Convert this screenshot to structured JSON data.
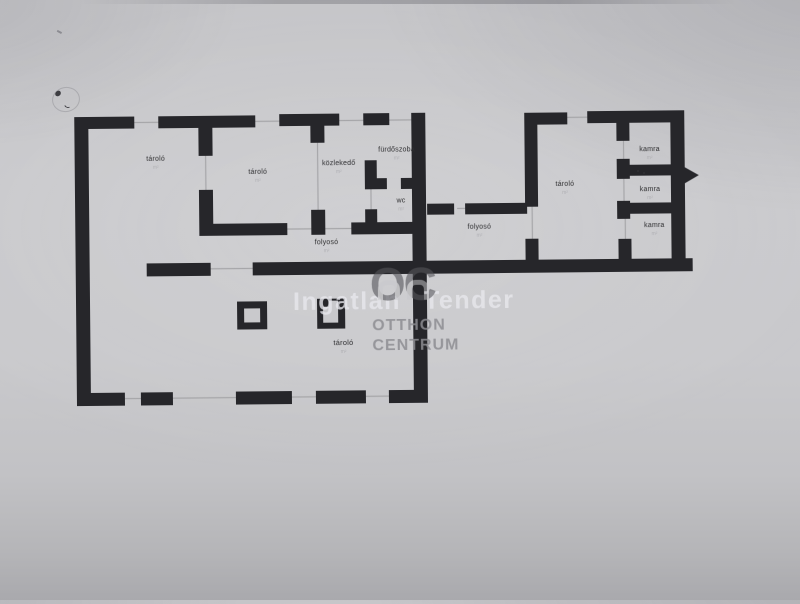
{
  "document": {
    "kind": "floor plan sketch (scanned photo)",
    "language": "Hungarian"
  },
  "colors": {
    "paper": "#c9c9cc",
    "wall": "#26262a",
    "room_label": "#2e2e30",
    "area_text": "#b0b0b4",
    "watermark_light": "#e7e7ec",
    "watermark_gray": "#8d8d92"
  },
  "rooms": [
    {
      "name": "tarolo-top-left",
      "label": "tároló",
      "area": "m²"
    },
    {
      "name": "tarolo-top-mid",
      "label": "tároló",
      "area": "m²"
    },
    {
      "name": "kozlekedo",
      "label": "közlekedő",
      "area": "m²"
    },
    {
      "name": "furdoszoba",
      "label": "fürdőszoba",
      "area": "m²"
    },
    {
      "name": "wc",
      "label": "wc",
      "area": "m²"
    },
    {
      "name": "folyoso-left",
      "label": "folyosó",
      "area": "m²"
    },
    {
      "name": "folyoso-right",
      "label": "folyosó",
      "area": "m²"
    },
    {
      "name": "tarolo-right",
      "label": "tároló",
      "area": "m²"
    },
    {
      "name": "kamra-top",
      "label": "kamra",
      "area": "m²"
    },
    {
      "name": "kamra-middle",
      "label": "kamra",
      "area": "m²"
    },
    {
      "name": "kamra-bottom",
      "label": "kamra",
      "area": "m²"
    },
    {
      "name": "tarolo-bottom",
      "label": "tároló",
      "area": "m²"
    }
  ],
  "watermark": {
    "word_left": "Ingatlan",
    "word_right": "Tender",
    "logo_text": "OC",
    "brand_line1": "OTTHON",
    "brand_line2": "CENTRUM"
  }
}
